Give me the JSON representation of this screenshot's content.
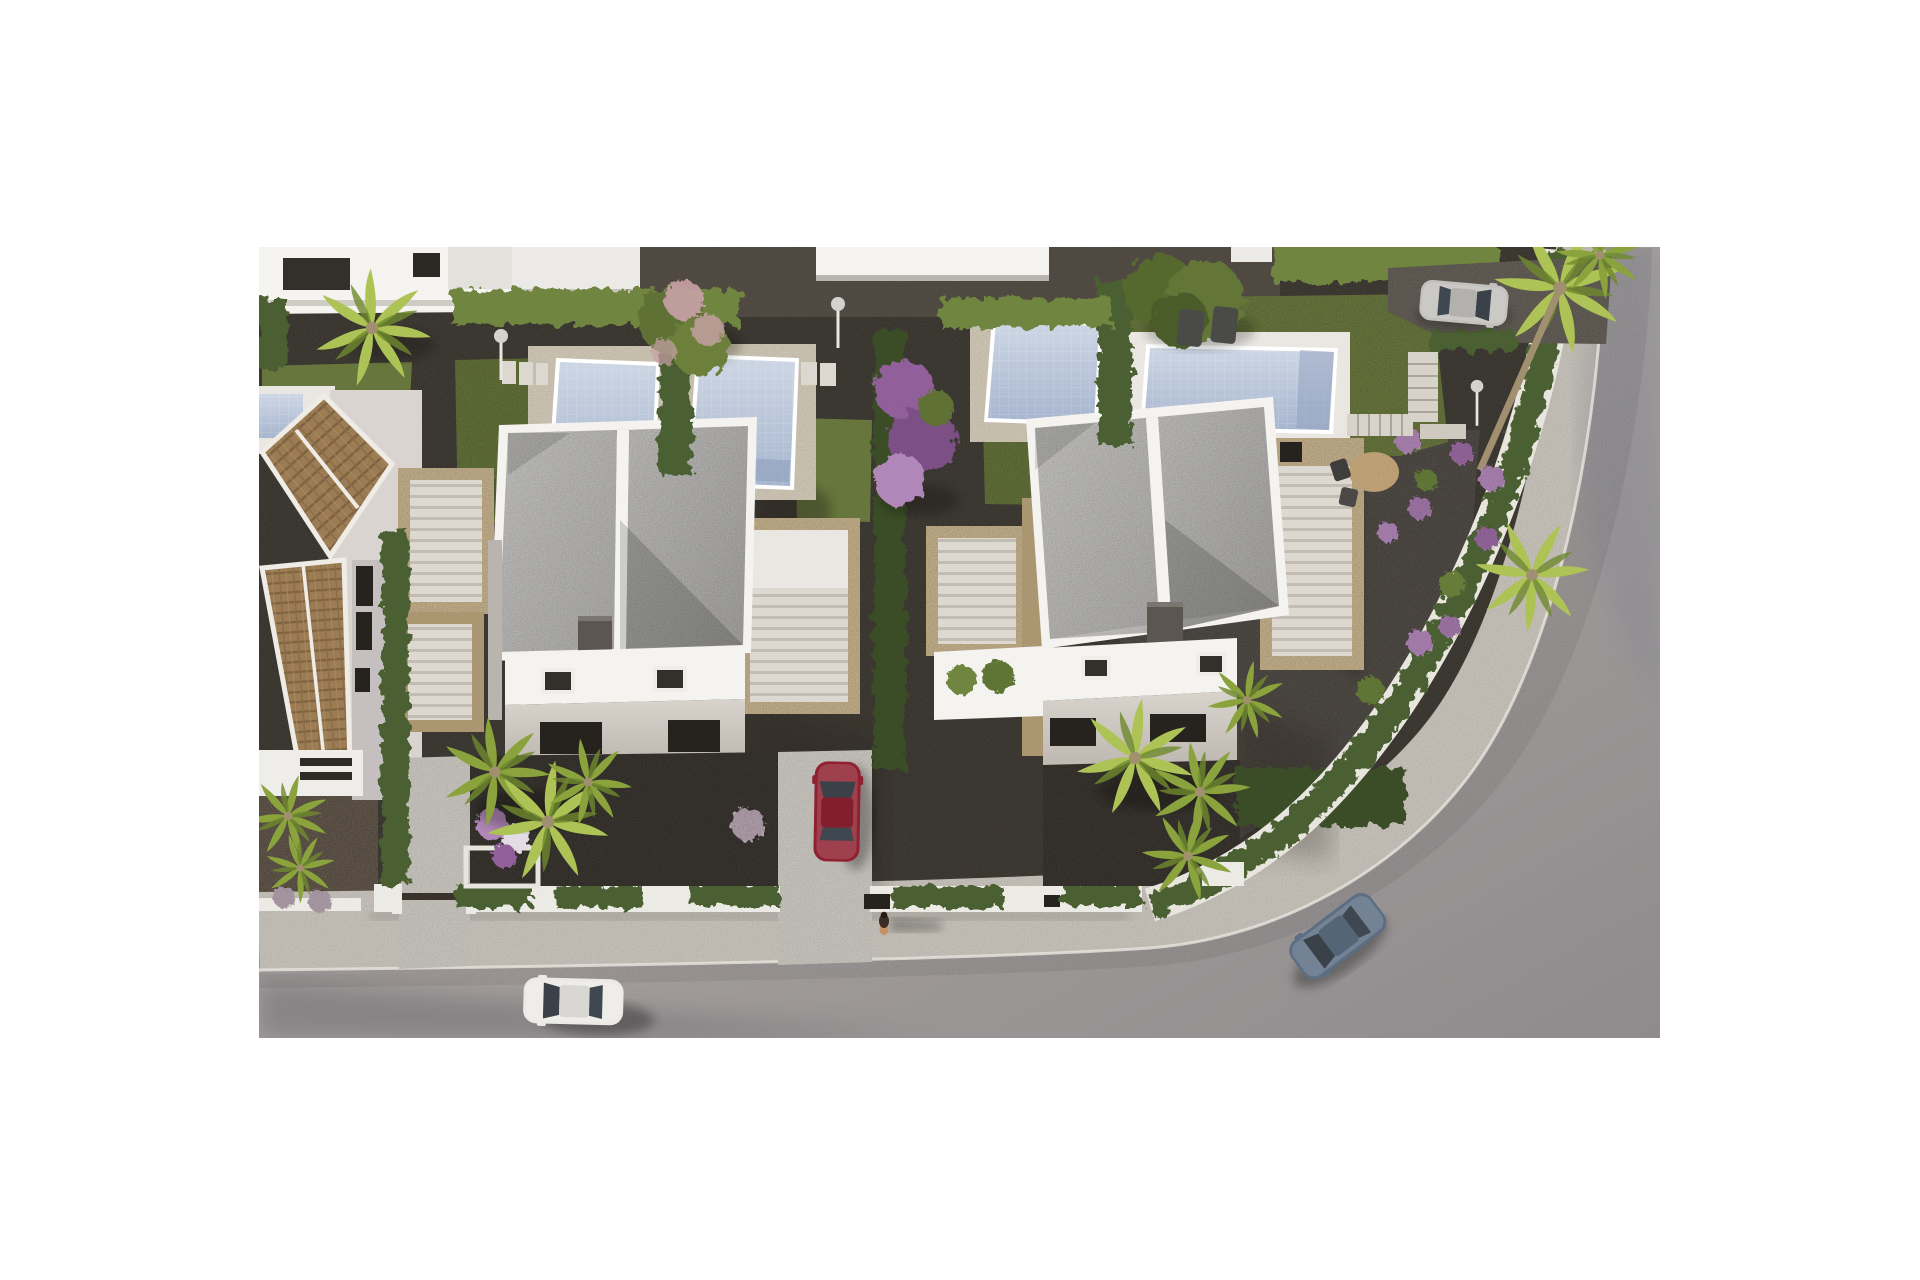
{
  "image": {
    "kind": "photorealistic 3D architectural rendering",
    "view": "aerial top-down (slightly oblique), late-afternoon sun from the west",
    "subject": "new-build residential development: two modern white villas with pools, gardens and a curving street",
    "frame": "white margin around rendering; render area approx x259-1660, y247-1038 of 1920x1280"
  },
  "palette": {
    "page_bg": "#ffffff",
    "road_light": "#b3adaa",
    "road_dark": "#8f8b8d",
    "sidewalk": "#cbc6be",
    "curb": "#e8e5df",
    "gravel_dark": "#46413a",
    "gravel_mid": "#5d564c",
    "gravel_warm": "#6b5f52",
    "grass": "#67763d",
    "grass_dark": "#4f6030",
    "hedge": "#4c6132",
    "hedge_dark": "#3a4d26",
    "hedge_light": "#70853f",
    "palm_light": "#aec355",
    "palm_mid": "#8aa33c",
    "trunk": "#a19070",
    "pool_light": "#cdd6e4",
    "pool_deep": "#a7b6cf",
    "deck_white": "#eae7e2",
    "deck_beige": "#d6cdbb",
    "villa_white": "#f4f3f0",
    "villa_face": "#cfc9c2",
    "roof_light": "#c9c8c6",
    "roof_dark": "#b0afad",
    "stone": "#c9b58f",
    "stone_dark": "#ab9672",
    "tile_brown": "#9c7c54",
    "tile_dark": "#7f6340",
    "window_dark": "#26231f",
    "car_white": "#eceae7",
    "car_red": "#8f2130",
    "car_silver": "#c2c1bd",
    "car_blue": "#5d6e83",
    "purple": "#91619a",
    "purple_light": "#b186b8",
    "pink_blossom": "#c9a2a8",
    "lavender": "#b3a2ae",
    "tan_table": "#c8a97c",
    "chimney": "#5b5650"
  },
  "scene": {
    "buildings": [
      {
        "name": "villa-1",
        "style": "modern white, flat speckled-gray roof in two halves, dark chimney, travertine stair terraces both sides, glazed front with two skylights"
      },
      {
        "name": "villa-2",
        "style": "modern white, flat speckled-gray roof in two halves, dark chimney, travertine stair terraces both sides, glazed front with two skylights"
      },
      {
        "name": "old-house-left",
        "style": "existing house with terracotta tiled pitched roofs, white walls, dark windows, carport"
      },
      {
        "name": "back-row-buildings",
        "style": "partial white flat-roof villas along top edge"
      }
    ],
    "pools": [
      {
        "name": "pool-back-left-edge",
        "note": "partially visible at left edge"
      },
      {
        "name": "pool-a",
        "note": "vertical pool with deck, back garden left"
      },
      {
        "name": "pool-b",
        "note": "vertical pool with deck, back garden center-left"
      },
      {
        "name": "pool-c",
        "note": "vertical pool with deck, back garden center-right"
      },
      {
        "name": "pool-d",
        "note": "horizontal pool with white deck in right corner garden"
      }
    ],
    "vehicles": [
      {
        "name": "white-car",
        "state": "driving on street, bottom-left"
      },
      {
        "name": "red-car",
        "state": "parked in driveway between villas"
      },
      {
        "name": "silver-car",
        "state": "parked on gravel drive, top-right"
      },
      {
        "name": "blue-car",
        "state": "driving around the corner, bottom-right"
      }
    ],
    "people": [
      {
        "name": "pedestrian",
        "state": "walking on sidewalk, long shadow to the east"
      }
    ],
    "landscape": [
      "cypress hedges between plots",
      "banana plant",
      "pink-blossom tree",
      "purple bougainvillea",
      "large green tree",
      "fan palms",
      "purple flower balls",
      "lavender balls",
      "lawns",
      "dark gravel paths"
    ],
    "street_furniture": [
      "round bistro table with two chairs",
      "two sun loungers",
      "garden stairs",
      "white pool showers / lamps",
      "low white boundary walls with hedges",
      "dark pedestrian gates"
    ]
  }
}
